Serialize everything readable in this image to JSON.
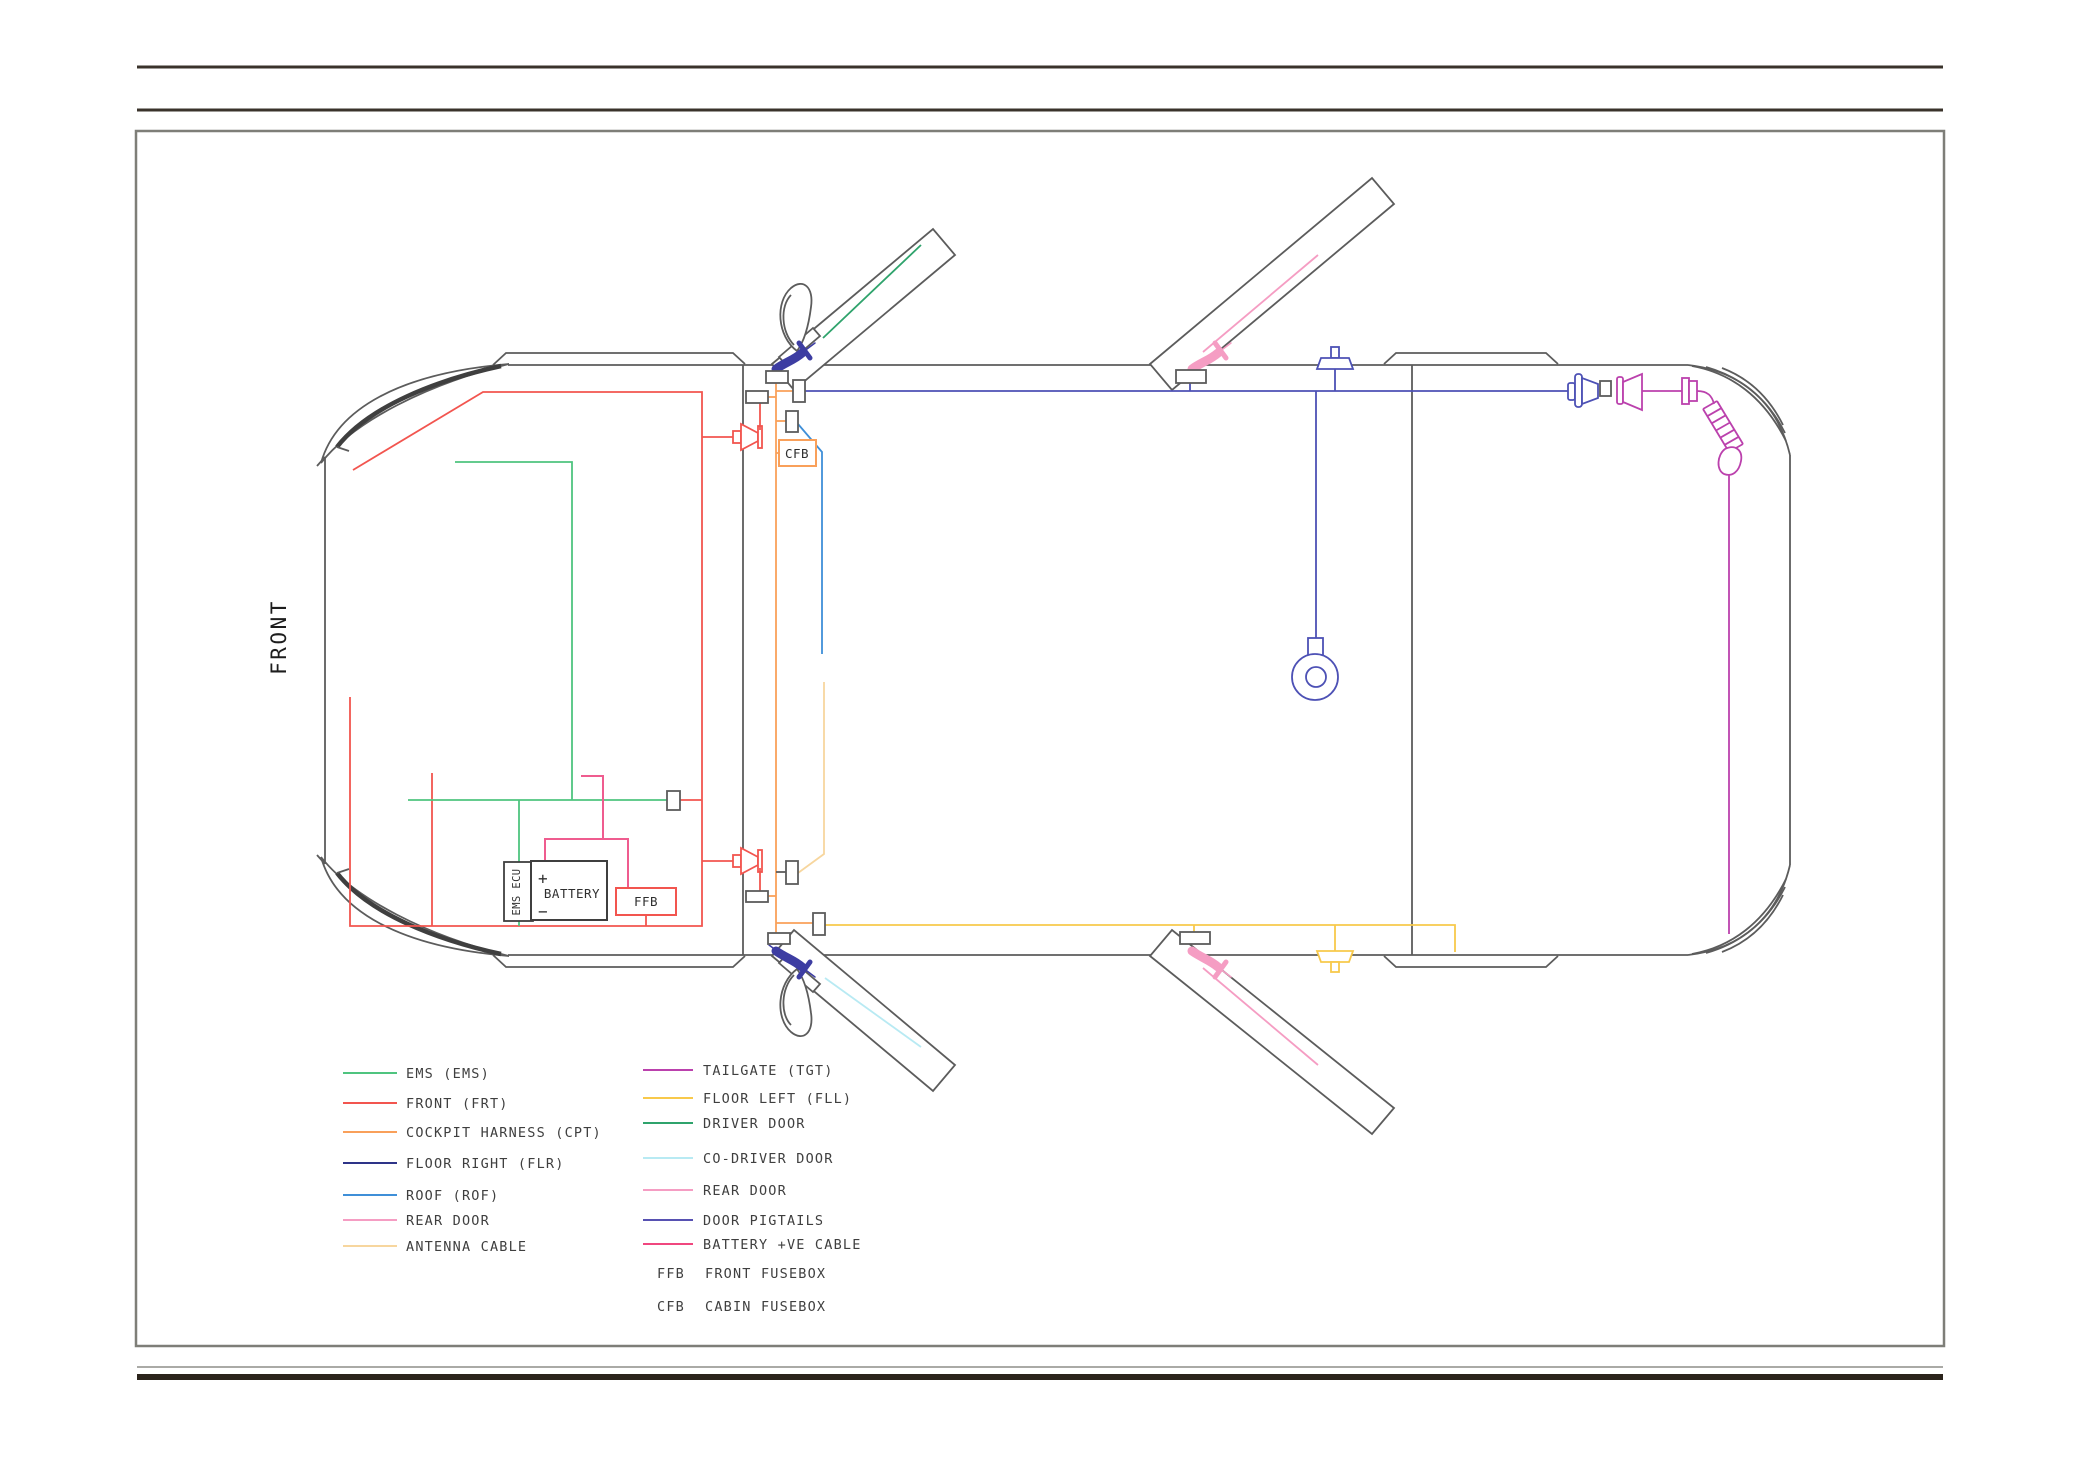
{
  "page": {
    "front_label": "FRONT",
    "battery_label": "BATTERY",
    "battery_plus": "+",
    "battery_minus": "−",
    "ffb_label": "FFB",
    "cfb_label": "CFB",
    "ems_ecu_label": "EMS ECU"
  },
  "palette": {
    "outline_grey": "#5c5c5c",
    "dark_accent": "#3f3f3f",
    "ems_green": "#4fc47f",
    "front_red": "#f2554f",
    "cockpit_orange": "#f9a05a",
    "floor_right_line": "#4d51b5",
    "roof_blue": "#3f8fd8",
    "rear_door_pink": "#f59dc3",
    "antenna_peach": "#f7d69e",
    "tailgate_magenta": "#bb41ad",
    "floor_left_yellow": "#f8c94b",
    "driver_door_green": "#2fa36c",
    "codriver_cyan": "#b8eaf3",
    "pigtail_navy": "#3d3da2",
    "battery_cable_pink": "#ef5c8f",
    "rule_dark": "#3a332b",
    "rule_thick": "#2b241c",
    "rule_thin": "#8e8e88",
    "frame_grey": "#7e7e78"
  },
  "legend": {
    "left": [
      {
        "label": "EMS (EMS)",
        "color": "#4fc47f"
      },
      {
        "label": "FRONT (FRT)",
        "color": "#f2554f"
      },
      {
        "label": "COCKPIT HARNESS (CPT)",
        "color": "#f9a05a"
      },
      {
        "label": "FLOOR RIGHT (FLR)",
        "color": "#2e3488"
      },
      {
        "label": "ROOF (ROF)",
        "color": "#3f8fd8"
      },
      {
        "label": "REAR DOOR",
        "color": "#f59dc3"
      },
      {
        "label": "ANTENNA CABLE",
        "color": "#f7d69e"
      }
    ],
    "right": [
      {
        "label": "TAILGATE (TGT)",
        "color": "#bb41ad"
      },
      {
        "label": "FLOOR LEFT (FLL)",
        "color": "#f8c94b"
      },
      {
        "label": "DRIVER DOOR",
        "color": "#2fa36c"
      },
      {
        "label": "CO-DRIVER DOOR",
        "color": "#b8eaf3"
      },
      {
        "label": "REAR DOOR",
        "color": "#f59dc3"
      },
      {
        "label": "DOOR PIGTAILS",
        "color": "#5751b2"
      },
      {
        "label": "BATTERY +VE CABLE",
        "color": "#f0477f"
      }
    ],
    "abbreviations": [
      {
        "abbr": "FFB",
        "label": "FRONT FUSEBOX"
      },
      {
        "abbr": "CFB",
        "label": "CABIN FUSEBOX"
      }
    ]
  }
}
